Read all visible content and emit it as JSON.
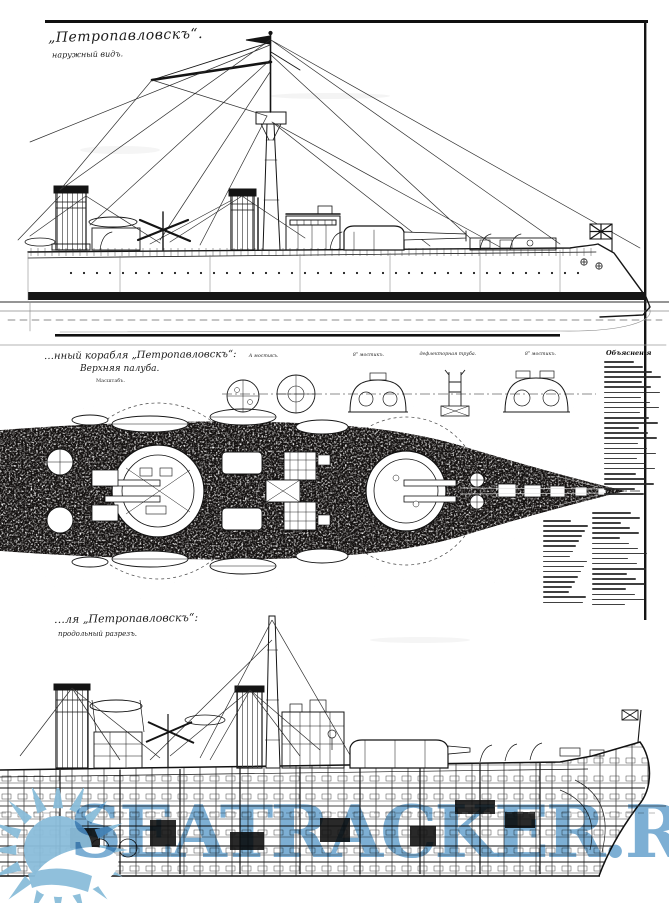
{
  "page": {
    "paper_color": "#ffffff",
    "ink_color": "#1b1b1b"
  },
  "views": {
    "side": {
      "title": "„Петропавловскъ“.",
      "subtitle": "наружный видъ."
    },
    "plan": {
      "title_fragment": "…нный корабля „Петропавловскъ“:",
      "subtitle": "Верхняя палуба.",
      "scale_note": "Масштабъ.",
      "section_labels": [
        "А мостикъ.",
        "8ʺ мостикъ.",
        "дефлекторная труба.",
        "8ʺ мостикъ."
      ],
      "legend": {
        "title": "Объясненія",
        "items_legible": false,
        "columns": [
          {
            "left": 604,
            "top": 361,
            "count": 27,
            "min_width": 30,
            "max_width": 58
          },
          {
            "left": 592,
            "top": 512,
            "count": 19,
            "min_width": 28,
            "max_width": 56
          },
          {
            "left": 543,
            "top": 520,
            "count": 17,
            "min_width": 26,
            "max_width": 46
          }
        ]
      }
    },
    "section": {
      "title_fragment": "…ля „Петропавловскъ“:",
      "subtitle": "продольный разрезъ."
    }
  },
  "watermark": {
    "text": "SEATRACKER.RU",
    "text_color": "#609dca",
    "sun_color": "#8abdda"
  }
}
